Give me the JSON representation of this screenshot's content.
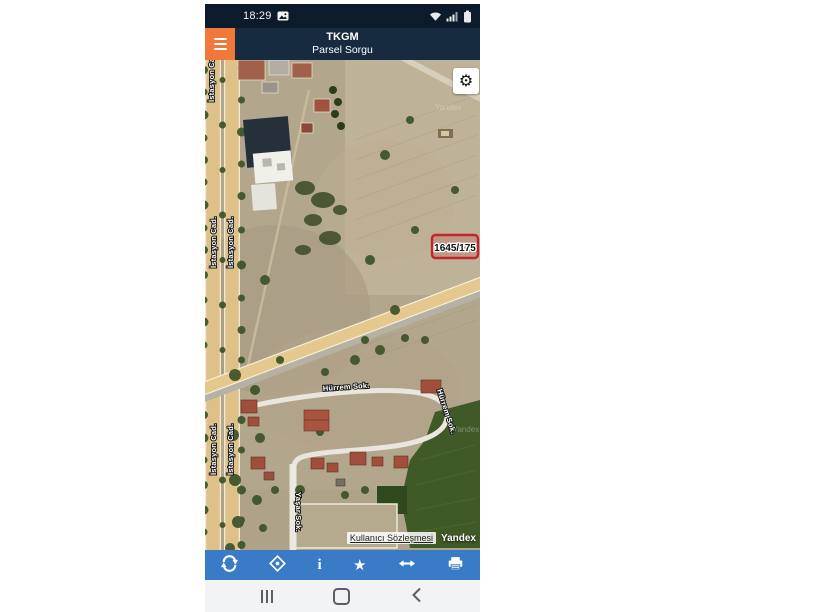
{
  "status_bar": {
    "time": "18:29",
    "icons": [
      "gallery-notification",
      "wifi",
      "cellular-signal",
      "battery"
    ]
  },
  "header": {
    "title": "TKGM",
    "subtitle": "Parsel Sorgu",
    "menu_icon": "hamburger"
  },
  "map": {
    "parcel": {
      "label": "1645/175"
    },
    "streets": {
      "istasyon": "İstasyon Cad.",
      "hurrem": "Hürrem Sok.",
      "yasar": "Yaşar Sok."
    },
    "watermark": "Yandex",
    "attribution": {
      "terms_link": "Kullanıcı Sözleşmesi",
      "provider": "Yandex"
    },
    "settings_icon": "gear"
  },
  "toolbar": {
    "buttons": [
      {
        "name": "refresh"
      },
      {
        "name": "locate"
      },
      {
        "name": "info"
      },
      {
        "name": "favorite"
      },
      {
        "name": "measure"
      },
      {
        "name": "print"
      }
    ],
    "info_glyph": "i",
    "star_glyph": "★"
  },
  "nav_bar": {
    "buttons": [
      "recents",
      "home",
      "back"
    ]
  },
  "colors": {
    "status_bg": "#0b1b2b",
    "header_bg": "#162a40",
    "menu_orange": "#f0793a",
    "toolbar_blue": "#3a7bc8",
    "nav_bg": "#f2f3f5",
    "parcel_red": "#c5242b"
  }
}
